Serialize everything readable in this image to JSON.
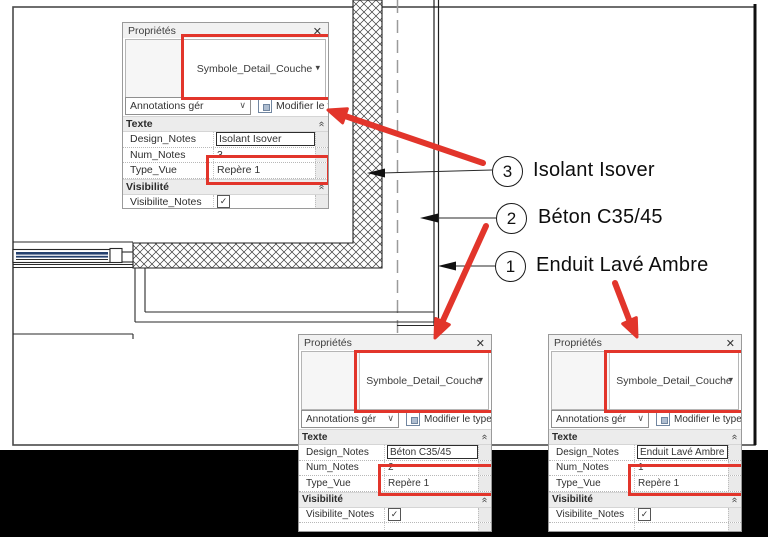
{
  "colors": {
    "highlight_red": "#e2352b",
    "window_navy": "#24406e"
  },
  "annotations": {
    "items": [
      {
        "num": "3",
        "label": "Isolant Isover"
      },
      {
        "num": "2",
        "label": "Béton C35/45"
      },
      {
        "num": "1",
        "label": "Enduit Lavé Ambre"
      }
    ]
  },
  "panels": [
    {
      "title": "Propriétés",
      "close_icon": "✕",
      "type_name": "Symbole_Detail_Couche",
      "dropdown_icon": "▾",
      "filter_label": "Annotations gér",
      "filter_icon": "∨",
      "modify_type_label": "Modifier le type",
      "collapse_icon": "«",
      "sections": {
        "texte": "Texte",
        "visibilite": "Visibilité"
      },
      "rows": {
        "design_label": "Design_Notes",
        "design_value": "Isolant Isover",
        "num_label": "Num_Notes",
        "num_value": "3",
        "type_label": "Type_Vue",
        "type_value": "Repère 1",
        "visib_label": "Visibilite_Notes",
        "check_icon": "✓"
      }
    },
    {
      "title": "Propriétés",
      "close_icon": "✕",
      "type_name": "Symbole_Detail_Couche",
      "dropdown_icon": "▾",
      "filter_label": "Annotations gér",
      "filter_icon": "∨",
      "modify_type_label": "Modifier le type",
      "collapse_icon": "«",
      "sections": {
        "texte": "Texte",
        "visibilite": "Visibilité"
      },
      "rows": {
        "design_label": "Design_Notes",
        "design_value": "Béton C35/45",
        "num_label": "Num_Notes",
        "num_value": "2",
        "type_label": "Type_Vue",
        "type_value": "Repère 1",
        "visib_label": "Visibilite_Notes",
        "check_icon": "✓"
      }
    },
    {
      "title": "Propriétés",
      "close_icon": "✕",
      "type_name": "Symbole_Detail_Couche",
      "dropdown_icon": "▾",
      "filter_label": "Annotations gér",
      "filter_icon": "∨",
      "modify_type_label": "Modifier le type",
      "collapse_icon": "«",
      "sections": {
        "texte": "Texte",
        "visibilite": "Visibilité"
      },
      "rows": {
        "design_label": "Design_Notes",
        "design_value": "Enduit Lavé Ambre",
        "num_label": "Num_Notes",
        "num_value": "1",
        "type_label": "Type_Vue",
        "type_value": "Repère 1",
        "visib_label": "Visibilite_Notes",
        "check_icon": "✓"
      }
    }
  ]
}
